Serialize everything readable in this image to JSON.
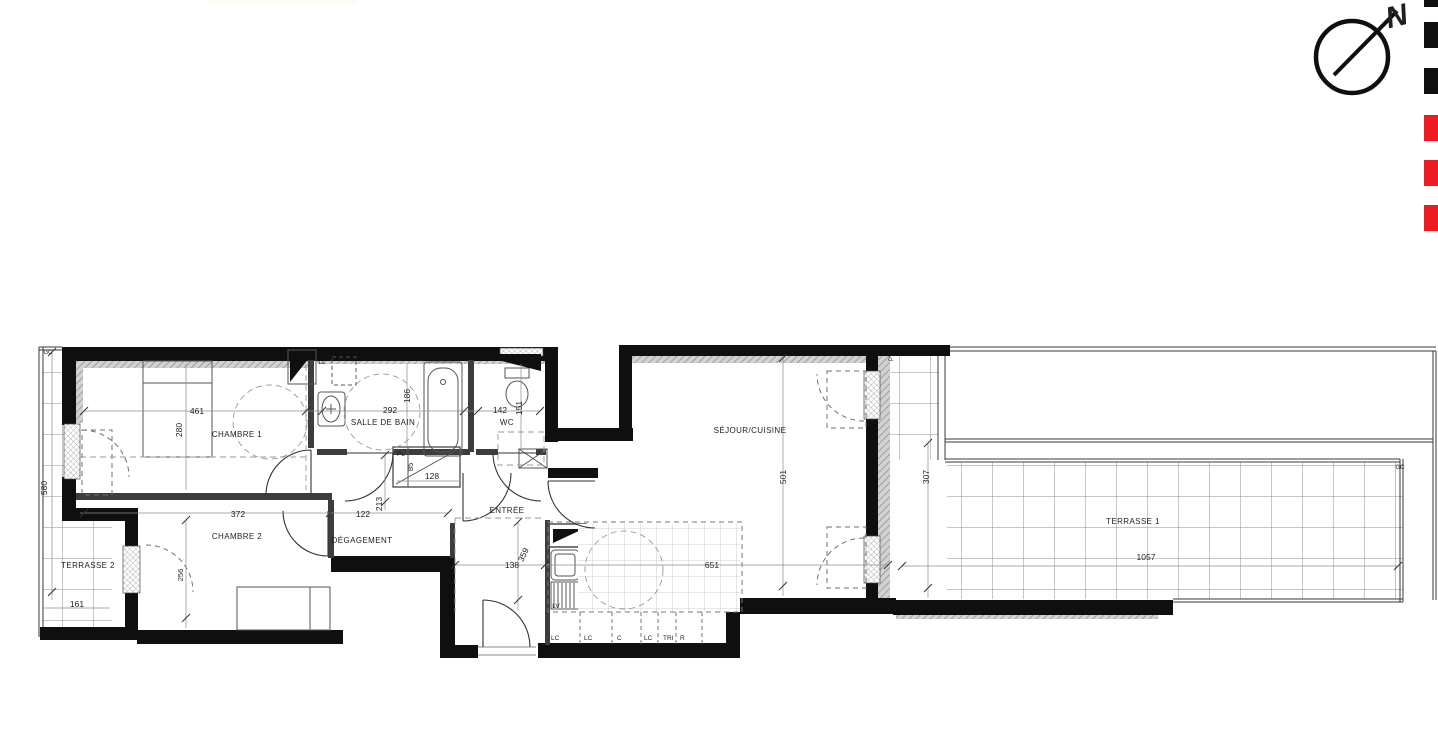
{
  "palette": {
    "paper": "#ffffff",
    "ink": "#1f1f1f",
    "wall": "#0f0f0f",
    "brand_red": "#EC1B23",
    "top_strip_cream": "#FFFCF2"
  },
  "compass": {
    "north_label": "N"
  },
  "brand_squares": [
    {
      "color": "#0f0f0f",
      "y": -19
    },
    {
      "color": "#0f0f0f",
      "y": 22
    },
    {
      "color": "#0f0f0f",
      "y": 68
    },
    {
      "color": "#EC1B23",
      "y": 115
    },
    {
      "color": "#EC1B23",
      "y": 160
    },
    {
      "color": "#EC1B23",
      "y": 205
    }
  ],
  "rooms": [
    {
      "id": "chambre-1",
      "label": "CHAMBRE 1",
      "x": 237,
      "y": 437
    },
    {
      "id": "salle-de-bain",
      "label": "SALLE DE BAIN",
      "x": 383,
      "y": 425
    },
    {
      "id": "wc",
      "label": "WC",
      "x": 507,
      "y": 425
    },
    {
      "id": "chambre-2",
      "label": "CHAMBRE 2",
      "x": 237,
      "y": 539
    },
    {
      "id": "degagement",
      "label": "DÉGAGEMENT",
      "x": 362,
      "y": 543
    },
    {
      "id": "entree",
      "label": "ENTRÉE",
      "x": 507,
      "y": 513
    },
    {
      "id": "sejour-cuisine",
      "label": "SÉJOUR/CUISINE",
      "x": 750,
      "y": 433
    },
    {
      "id": "terrasse-1",
      "label": "TERRASSE 1",
      "x": 1133,
      "y": 524
    },
    {
      "id": "terrasse-2",
      "label": "TERRASSE 2",
      "x": 88,
      "y": 568
    }
  ],
  "dimensions": [
    {
      "id": "461",
      "value": "461",
      "x": 197,
      "y": 414
    },
    {
      "id": "280",
      "value": "280",
      "x": 182,
      "y": 430,
      "rotate": -90
    },
    {
      "id": "292",
      "value": "292",
      "x": 390,
      "y": 413
    },
    {
      "id": "186",
      "value": "186",
      "x": 410,
      "y": 396,
      "rotate": -90
    },
    {
      "id": "142",
      "value": "142",
      "x": 500,
      "y": 413
    },
    {
      "id": "151",
      "value": "151",
      "x": 522,
      "y": 408,
      "rotate": -90
    },
    {
      "id": "372",
      "value": "372",
      "x": 238,
      "y": 517
    },
    {
      "id": "122",
      "value": "122",
      "x": 363,
      "y": 517
    },
    {
      "id": "213",
      "value": "213",
      "x": 382,
      "y": 504,
      "rotate": -90
    },
    {
      "id": "128",
      "value": "128",
      "x": 432,
      "y": 479
    },
    {
      "id": "85",
      "value": "85",
      "x": 413,
      "y": 467,
      "rotate": -90,
      "size": 7.5
    },
    {
      "id": "138",
      "value": "138",
      "x": 512,
      "y": 568
    },
    {
      "id": "359",
      "value": "359",
      "x": 526,
      "y": 556,
      "rotate": -65
    },
    {
      "id": "651",
      "value": "651",
      "x": 712,
      "y": 568
    },
    {
      "id": "501",
      "value": "501",
      "x": 786,
      "y": 477,
      "rotate": -90
    },
    {
      "id": "307",
      "value": "307",
      "x": 929,
      "y": 477,
      "rotate": -90
    },
    {
      "id": "1057",
      "value": "1057",
      "x": 1146,
      "y": 560
    },
    {
      "id": "161",
      "value": "161",
      "x": 77,
      "y": 607
    },
    {
      "id": "580",
      "value": "580",
      "x": 47,
      "y": 488,
      "rotate": -90
    },
    {
      "id": "256",
      "value": "256",
      "x": 183,
      "y": 575,
      "rotate": -90,
      "size": 7.5
    }
  ],
  "labels": [
    {
      "id": "ll",
      "text": "LL",
      "x": 322,
      "y": 364,
      "size": 6.5
    },
    {
      "id": "pl",
      "text": "PL",
      "x": 401,
      "y": 456,
      "size": 6.5
    },
    {
      "id": "lv",
      "text": "LV",
      "x": 556,
      "y": 608,
      "size": 6.5
    },
    {
      "id": "pv",
      "text": "PV",
      "x": 893,
      "y": 357,
      "size": 6,
      "rotate": -90
    },
    {
      "id": "gc-terrasse2",
      "text": "GC",
      "x": 48,
      "y": 354,
      "size": 6
    },
    {
      "id": "gc-terrasse1",
      "text": "GC",
      "x": 1400,
      "y": 469,
      "size": 6
    }
  ],
  "kitchen_cabinets": [
    {
      "id": "cab-lc-1",
      "text": "LC",
      "x": 551
    },
    {
      "id": "cab-lc-2",
      "text": "LC",
      "x": 584
    },
    {
      "id": "cab-c",
      "text": "C",
      "x": 617
    },
    {
      "id": "cab-lc-3",
      "text": "LC",
      "x": 644
    },
    {
      "id": "cab-tri",
      "text": "TRI",
      "x": 663
    },
    {
      "id": "cab-r",
      "text": "R",
      "x": 680
    }
  ]
}
